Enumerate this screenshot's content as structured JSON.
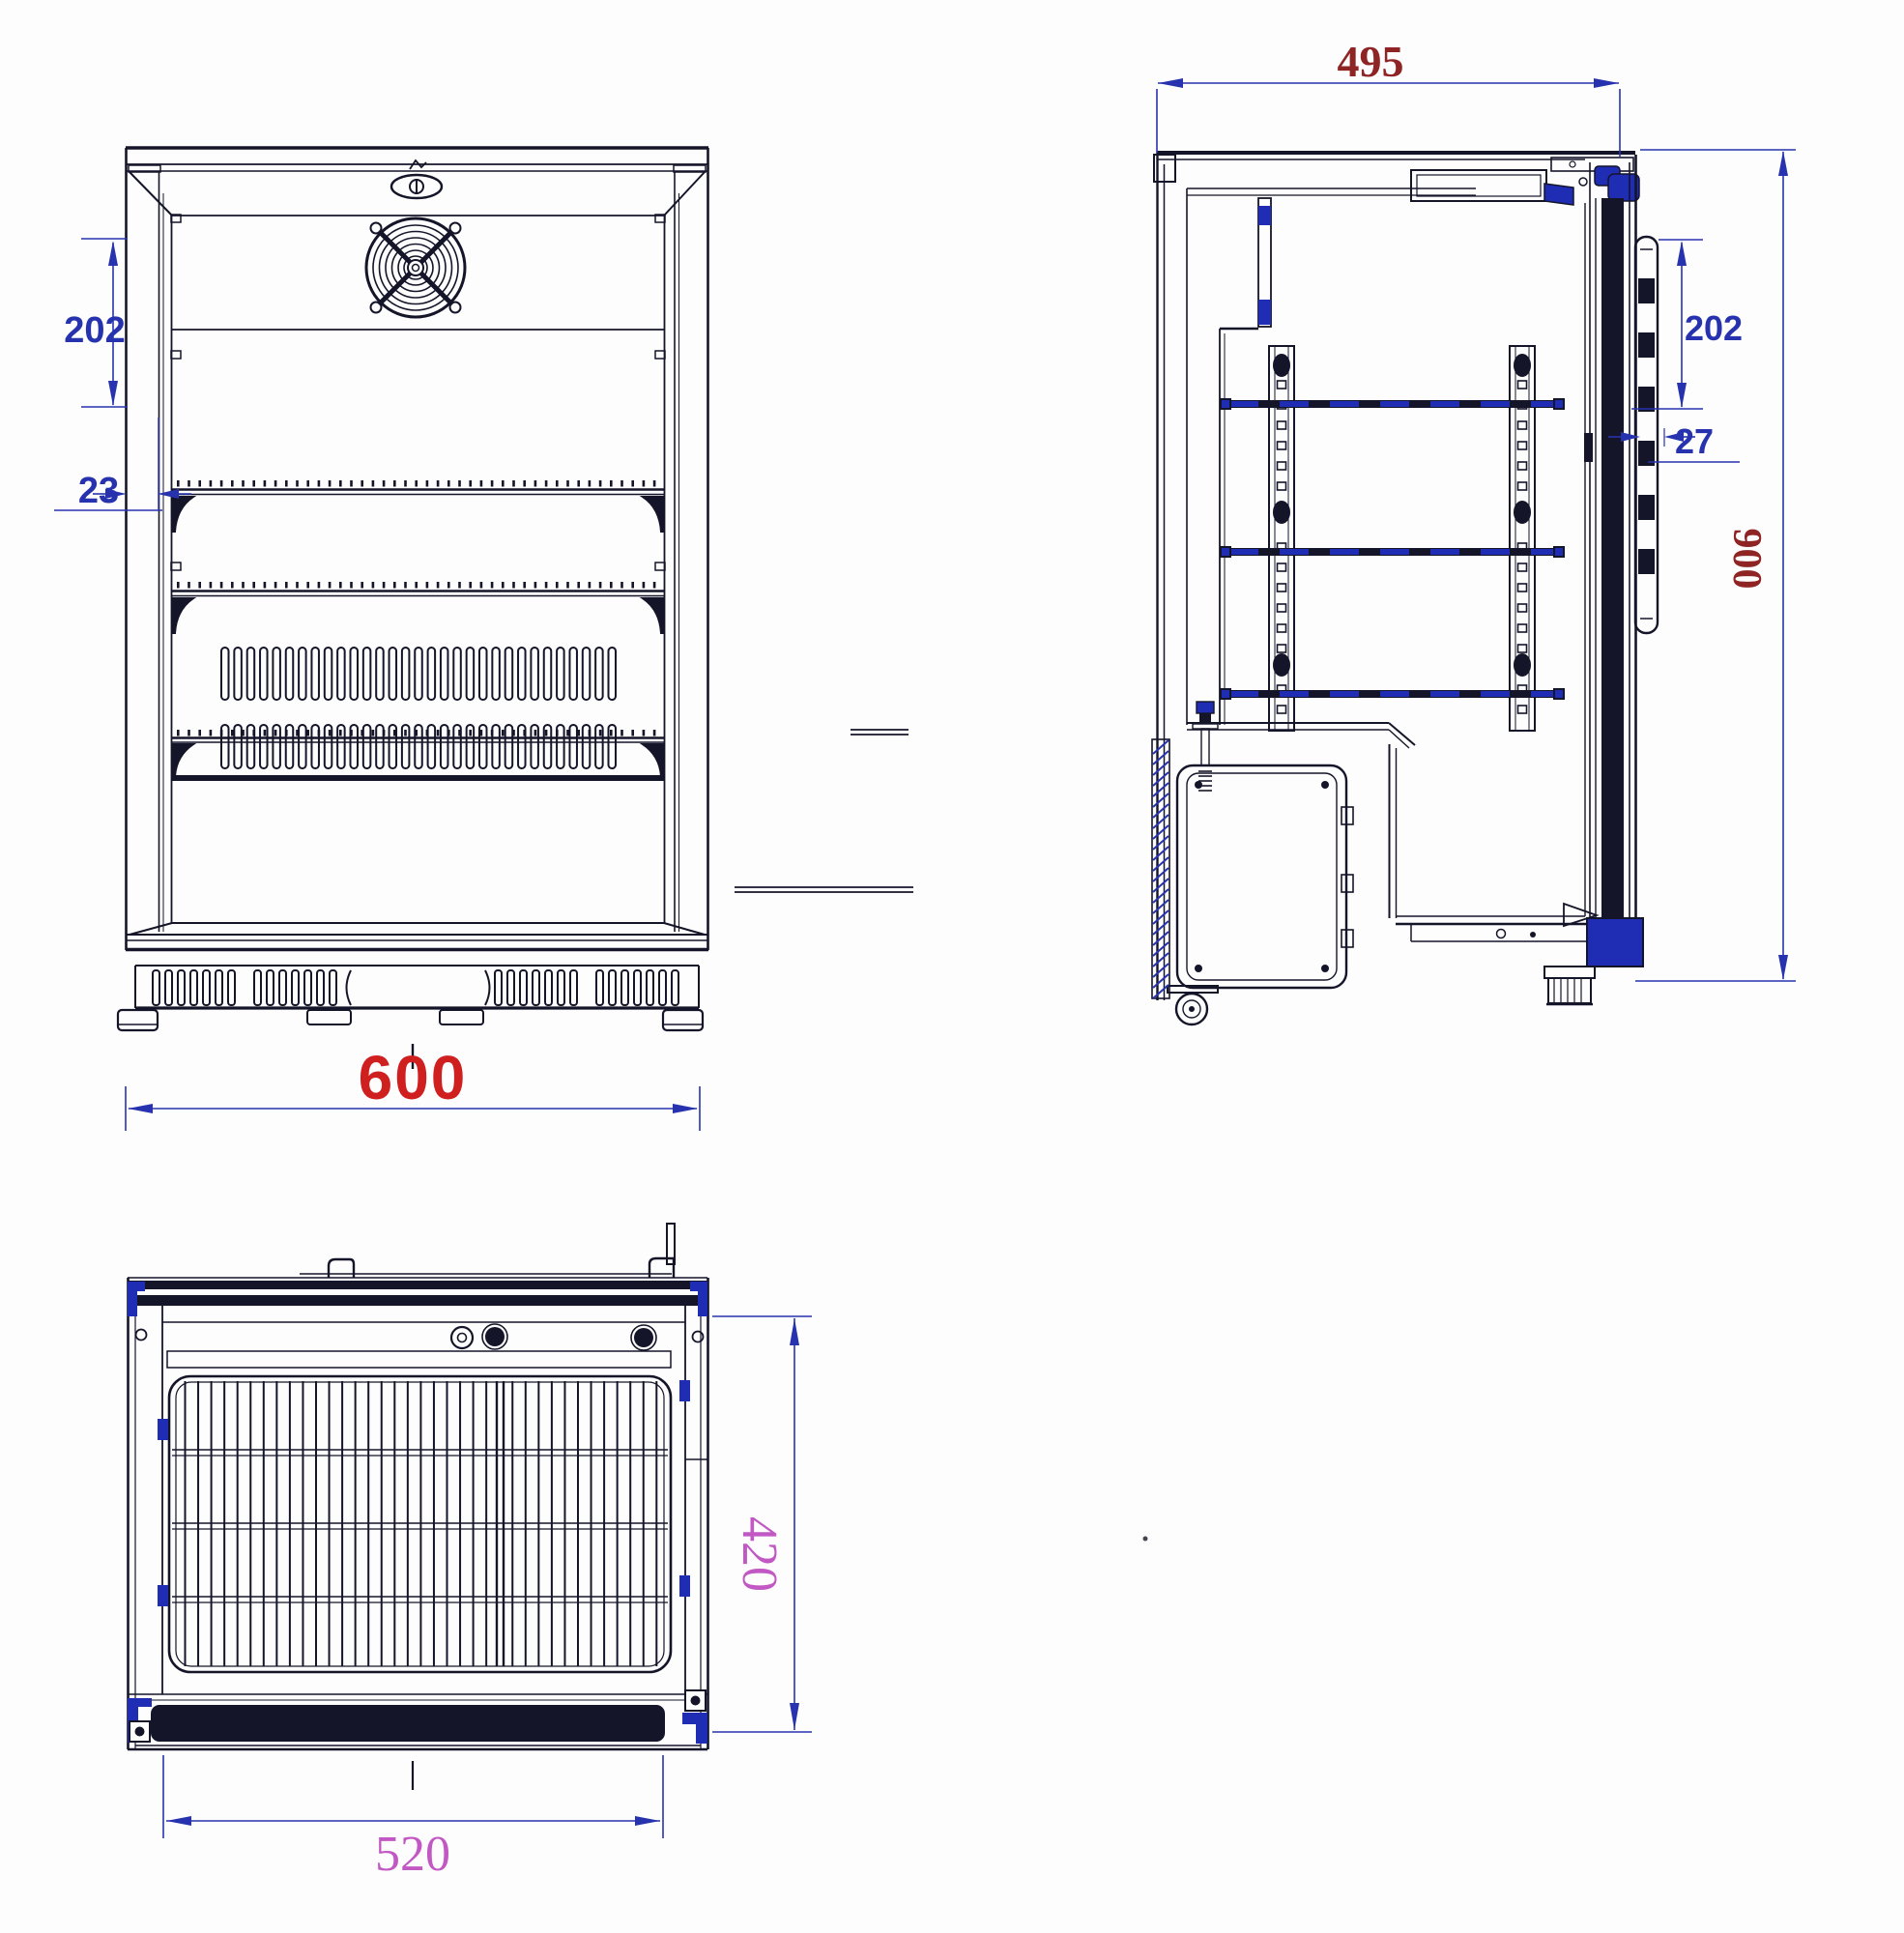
{
  "drawing": {
    "type": "technical-orthographic-drawing",
    "subject": "single-door back-bar bottle cooler",
    "views": [
      "front",
      "side",
      "top"
    ],
    "dimensions": {
      "front": {
        "handle_height": "202",
        "handle_offset": "23",
        "width": "600"
      },
      "side": {
        "depth": "495",
        "handle_height": "202",
        "handle_clearance": "27",
        "height": "900"
      },
      "top": {
        "depth": "420",
        "door_width": "520"
      }
    },
    "colors": {
      "line_ink": "#15152a",
      "dimension_blue": "#2733ae",
      "accent_blue": "#1f2cb4",
      "width_red": "#cf1f1f",
      "depth_maroon": "#8e2424",
      "plan_magenta": "#c258c4",
      "background": "#fdfdfd"
    }
  }
}
